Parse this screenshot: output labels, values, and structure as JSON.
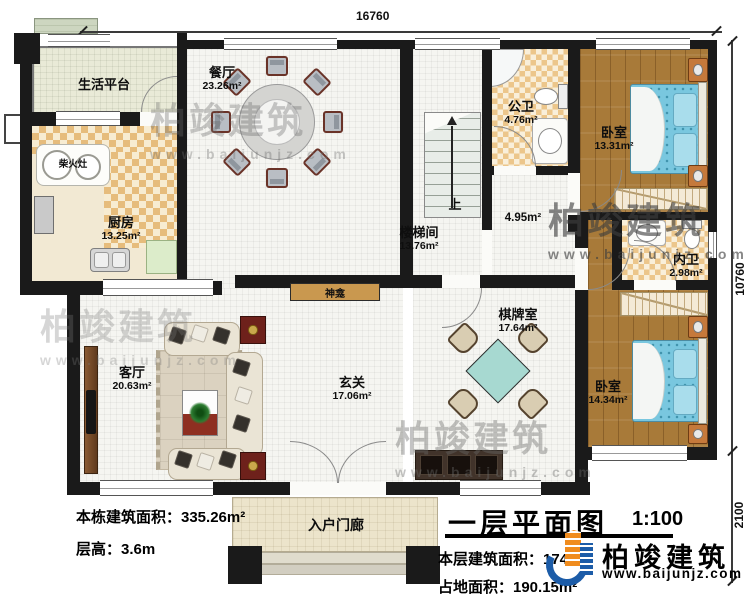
{
  "title": {
    "main": "一层平面图",
    "scale": "1:100"
  },
  "dimensions": {
    "top": "16760",
    "right_upper": "10760",
    "right_lower": "2100"
  },
  "rooms": {
    "platform": {
      "name": "生活平台"
    },
    "dining": {
      "name": "餐厅",
      "area": "23.26m²"
    },
    "kitchen": {
      "name": "厨房",
      "area": "13.25m²"
    },
    "stove": {
      "name": "柴火灶"
    },
    "bath_public": {
      "name": "公卫",
      "area": "4.76m²"
    },
    "bedroom_top": {
      "name": "卧室",
      "area": "13.31m²"
    },
    "stairwell": {
      "name": "楼梯间",
      "area": "13.76m²"
    },
    "corridor": {
      "area": "4.95m²"
    },
    "stairs_up": {
      "label": "上"
    },
    "bath_private": {
      "name": "内卫",
      "area": "2.98m²"
    },
    "chess": {
      "name": "棋牌室",
      "area": "17.64m²"
    },
    "bedroom_bottom": {
      "name": "卧室",
      "area": "14.34m²"
    },
    "living": {
      "name": "客厅",
      "area": "20.63m²"
    },
    "foyer": {
      "name": "玄关",
      "area": "17.06m²"
    },
    "shrine": {
      "name": "神龛"
    },
    "porch": {
      "name": "入户门廊"
    }
  },
  "stats": {
    "building_area": "本栋建筑面积：335.26m²",
    "floor_height": "层高：3.6m",
    "floor_area": "本层建筑面积：174",
    "site_area": "占地面积：190.15m²"
  },
  "brand": {
    "name": "柏竣建筑",
    "url": "www.baijunjz.com",
    "blue": "#1c5ca8",
    "orange": "#f08c1e"
  },
  "watermark": {
    "text": "柏竣建筑",
    "url": "www.baijunjz.com"
  }
}
